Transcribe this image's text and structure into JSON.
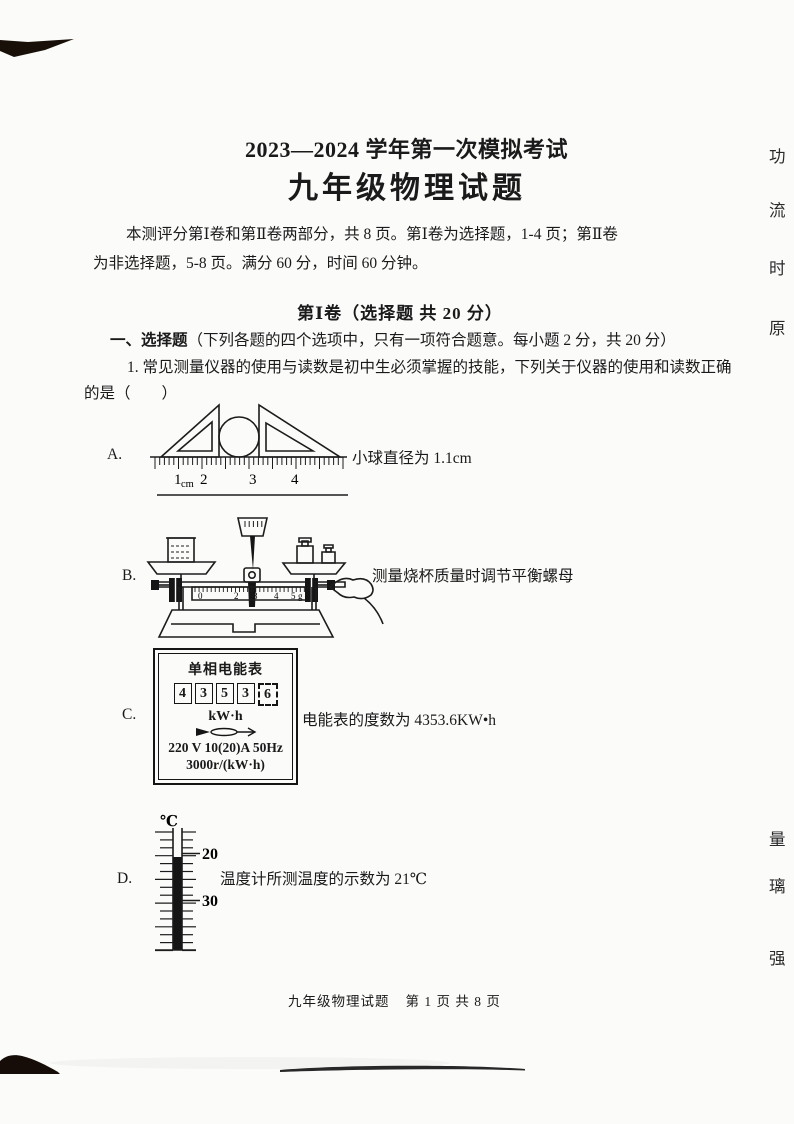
{
  "header": {
    "title": "2023—2024 学年第一次模拟考试",
    "subtitle": "九年级物理试题"
  },
  "intro": {
    "line1": "本测评分第Ⅰ卷和第Ⅱ卷两部分，共 8 页。第Ⅰ卷为选择题，1-4 页；第Ⅱ卷",
    "line2": "为非选择题，5-8 页。满分 60 分，时间 60 分钟。"
  },
  "section1": {
    "heading": "第Ⅰ卷（选择题  共 20 分）",
    "instruction_bold": "一、选择题",
    "instruction_rest": "（下列各题的四个选项中，只有一项符合题意。每小题 2 分，共 20 分）",
    "q1_line1": "1. 常见测量仪器的使用与读数是初中生必须掌握的技能，下列关于仪器的使用和读数正确",
    "q1_line2": "的是（　　）"
  },
  "options": {
    "a": {
      "label": "A.",
      "caption": "小球直径为 1.1cm"
    },
    "b": {
      "label": "B.",
      "caption": "测量烧杯质量时调节平衡螺母"
    },
    "c": {
      "label": "C.",
      "caption": "电能表的度数为 4353.6KW•h"
    },
    "d": {
      "label": "D.",
      "caption": "温度计所测温度的示数为 21℃"
    }
  },
  "ruler": {
    "n1": "1",
    "unit": "cm",
    "n2": "2",
    "n3": "3",
    "n4": "4"
  },
  "balance": {
    "s0": "0",
    "s2": "2",
    "s3": "3",
    "s4": "4",
    "s5": "5",
    "unit": "g"
  },
  "meter": {
    "title": "单相电能表",
    "d1": "4",
    "d2": "3",
    "d3": "5",
    "d4": "3",
    "d5": "6",
    "unit": "kW·h",
    "spec1": "220 V 10(20)A 50Hz",
    "spec2": "3000r/(kW·h)"
  },
  "thermometer": {
    "unit": "℃",
    "t20": "20",
    "t30": "30"
  },
  "footer": {
    "doc": "九年级物理试题",
    "page": "第 1 页 共 8 页"
  },
  "margin_chars": {
    "c1": "功",
    "c2": "流",
    "c3": "时",
    "c4": "原",
    "c5": "量",
    "c6": "璃",
    "c7": "强"
  }
}
